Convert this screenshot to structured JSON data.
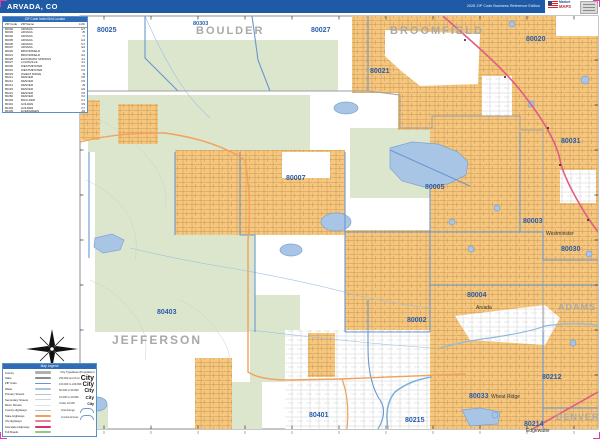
{
  "header": {
    "title": "ARVADA, CO",
    "edition": "2026 ZIP Code Business Reference Edition"
  },
  "logo": {
    "brand_top": "Market",
    "brand_bottom": "MAPS"
  },
  "colors": {
    "header_blue": "#1e5aa5",
    "urban_orange": "#f6c77c",
    "open_space_green": "#dbe6cd",
    "water_blue": "#a9c5e6",
    "zip_boundary_blue": "#6b97cf",
    "zip_label_blue": "#2a5caa",
    "county_label_gray": "#a9a9a9",
    "us_highway_pink": "#e05c86",
    "state_highway_orange": "#f0a25c"
  },
  "index_table": {
    "title": "ZIP Code Index/Grid Locator",
    "columns": [
      "ZIP Code",
      "ZIP Name",
      "LOC"
    ],
    "rows": [
      [
        "80002",
        "ARVADA",
        "H7"
      ],
      [
        "80003",
        "ARVADA",
        "J5"
      ],
      [
        "80004",
        "ARVADA",
        "I7"
      ],
      [
        "80005",
        "ARVADA",
        "H4"
      ],
      [
        "80006",
        "ARVADA",
        "H7"
      ],
      [
        "80007",
        "ARVADA",
        "E4"
      ],
      [
        "80020",
        "BROOMFIELD",
        "J1"
      ],
      [
        "80021",
        "BROOMFIELD",
        "G2"
      ],
      [
        "80025",
        "ELDORADO SPRINGS",
        "A1"
      ],
      [
        "80027",
        "LOUISVILLE",
        "F1"
      ],
      [
        "80030",
        "WESTMINSTER",
        "K6"
      ],
      [
        "80031",
        "WESTMINSTER",
        "K3"
      ],
      [
        "80033",
        "WHEAT RIDGE",
        "I9"
      ],
      [
        "80211",
        "DENVER",
        "K8"
      ],
      [
        "80212",
        "DENVER",
        "K9"
      ],
      [
        "80214",
        "DENVER",
        "J9"
      ],
      [
        "80215",
        "DENVER",
        "H9"
      ],
      [
        "80221",
        "DENVER",
        "K5"
      ],
      [
        "80260",
        "DENVER",
        "K2"
      ],
      [
        "80303",
        "BOULDER",
        "C1"
      ],
      [
        "80401",
        "GOLDEN",
        "F9"
      ],
      [
        "80403",
        "GOLDEN",
        "C7"
      ],
      [
        "80439",
        "EVERGREEN",
        "A9"
      ]
    ]
  },
  "map": {
    "county_labels": [
      {
        "text": "BOULDER",
        "x": 196,
        "y": 25,
        "size": 11,
        "ls": 2
      },
      {
        "text": "BROOMFIELD",
        "x": 390,
        "y": 25,
        "size": 11,
        "ls": 2
      },
      {
        "text": "JEFFERSON",
        "x": 112,
        "y": 333,
        "size": 12,
        "ls": 2
      },
      {
        "text": "ADAMS",
        "x": 558,
        "y": 302,
        "size": 9,
        "ls": 1
      },
      {
        "text": "DENVER",
        "x": 556,
        "y": 412,
        "size": 9,
        "ls": 1
      }
    ],
    "zip_labels": [
      {
        "text": "80025",
        "x": 97,
        "y": 27
      },
      {
        "text": "80303",
        "x": 193,
        "y": 21,
        "size": 5.5
      },
      {
        "text": "80027",
        "x": 311,
        "y": 27
      },
      {
        "text": "80020",
        "x": 526,
        "y": 36
      },
      {
        "text": "80021",
        "x": 370,
        "y": 68
      },
      {
        "text": "80007",
        "x": 286,
        "y": 175
      },
      {
        "text": "80005",
        "x": 425,
        "y": 184
      },
      {
        "text": "80031",
        "x": 561,
        "y": 138
      },
      {
        "text": "80003",
        "x": 523,
        "y": 218
      },
      {
        "text": "80030",
        "x": 561,
        "y": 246
      },
      {
        "text": "80004",
        "x": 467,
        "y": 292
      },
      {
        "text": "80002",
        "x": 407,
        "y": 317
      },
      {
        "text": "80403",
        "x": 157,
        "y": 309
      },
      {
        "text": "80033",
        "x": 469,
        "y": 393
      },
      {
        "text": "80212",
        "x": 542,
        "y": 374
      },
      {
        "text": "80401",
        "x": 309,
        "y": 412
      },
      {
        "text": "80215",
        "x": 405,
        "y": 417
      },
      {
        "text": "80214",
        "x": 524,
        "y": 421
      }
    ],
    "city_labels": [
      {
        "text": "Westminster",
        "x": 546,
        "y": 231
      },
      {
        "text": "Arvada",
        "x": 476,
        "y": 305
      },
      {
        "text": "Wheat Ridge",
        "x": 491,
        "y": 394
      },
      {
        "text": "Edgewater",
        "x": 526,
        "y": 428
      }
    ]
  },
  "legend": {
    "title": "Map Legend",
    "items": [
      {
        "label": "County",
        "swatch": "sw-county"
      },
      {
        "label": "State",
        "swatch": "sw-state"
      },
      {
        "label": "ZIP Code",
        "swatch": "sw-zip"
      },
      {
        "label": "Water",
        "swatch": "sw-water"
      },
      {
        "label": "Primary Streets",
        "swatch": "sw-prim"
      },
      {
        "label": "Secondary Streets",
        "swatch": "sw-sec"
      },
      {
        "label": "Minor Streets",
        "swatch": "sw-minor"
      },
      {
        "label": "County Highways",
        "swatch": "sw-chwy"
      },
      {
        "label": "State Highways",
        "swatch": "sw-shwy"
      },
      {
        "label": "US Highways",
        "swatch": "sw-uhwy"
      },
      {
        "label": "Interstate Highways",
        "swatch": "sw-ihwy"
      },
      {
        "label": "Toll Roads",
        "swatch": "sw-toll"
      }
    ],
    "city_sizes": {
      "header": "City Typefaces (Population)",
      "sample": "City",
      "rows": [
        {
          "range": "250,000 and Over",
          "px": 7
        },
        {
          "range": "100,000 to 249,999",
          "px": 6
        },
        {
          "range": "50,000 to 99,999",
          "px": 5
        },
        {
          "range": "10,000 to 49,999",
          "px": 4.5
        },
        {
          "range": "Under 10,000",
          "px": 3.5
        }
      ],
      "extras": [
        {
          "label": "Interchange"
        },
        {
          "label": "Limited Access"
        }
      ]
    }
  }
}
